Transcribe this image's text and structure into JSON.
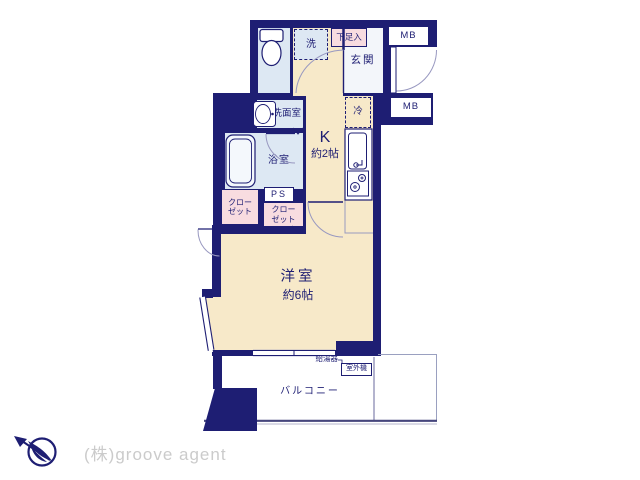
{
  "plan": {
    "labels": {
      "laundry": "洗",
      "shoe_cupboard": "下足入",
      "entrance": "玄関",
      "meter_box": "MB",
      "refrigerator": "冷",
      "washroom": "洗面室",
      "bathroom": "浴室",
      "kitchen": "K",
      "kitchen_size": "約2帖",
      "pipe_space": "PS",
      "closet_line1": "クロー",
      "closet_line2": "ゼット",
      "western_room": "洋室",
      "western_room_size": "約6帖",
      "balcony": "バルコニー",
      "water_heater": "給湯器",
      "ac_outdoor_unit": "室外機"
    },
    "rooms_summary": [
      {
        "name": "K",
        "size": "約2帖"
      },
      {
        "name": "洋室",
        "size": "約6帖"
      }
    ],
    "colors": {
      "wall_navy": "#1e1e73",
      "room_cream": "#f7e9c9",
      "room_light_blue": "#dde8f3",
      "room_pink": "#f8dce0",
      "entrance_white": "#f3f6fa",
      "thin_line_gray": "#9898c0",
      "logo_gray": "#cbcbcb"
    },
    "icons": {
      "compass": "north-arrow-bird-icon",
      "fixtures": [
        "toilet",
        "washbasin",
        "bathtub",
        "kitchen-sink",
        "two-burner-stove"
      ]
    }
  },
  "footer": {
    "company": "(株)groove agent"
  }
}
